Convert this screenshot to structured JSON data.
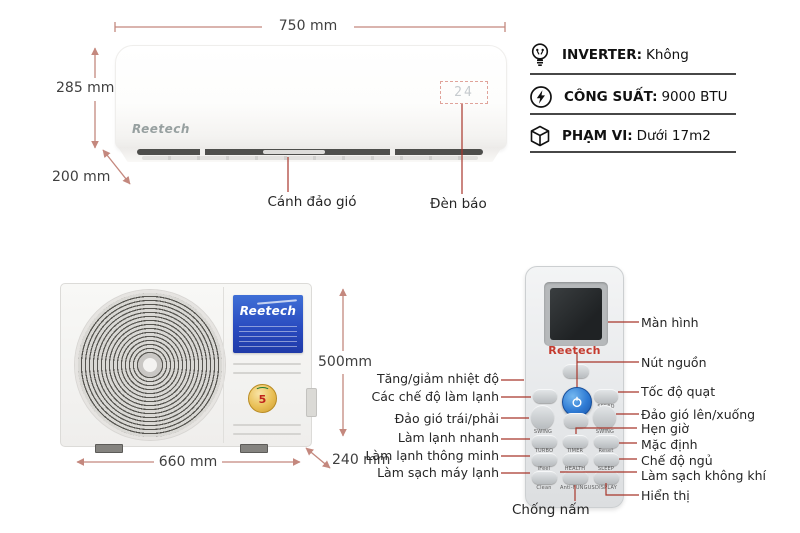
{
  "indoor": {
    "brand": "Reetech",
    "display_value": "24",
    "dim_width": "750 mm",
    "dim_height": "285 mm",
    "dim_depth": "200 mm",
    "label_swing": "Cánh đảo gió",
    "label_indicator": "Đèn báo"
  },
  "specs": [
    {
      "icon": "bulb-icon",
      "label": "INVERTER:",
      "value": "Không"
    },
    {
      "icon": "lightning-icon",
      "label": "CÔNG SUẤT:",
      "value": "9000 BTU"
    },
    {
      "icon": "cube-icon",
      "label": "PHẠM VI:",
      "value": "Dưới 17m2"
    }
  ],
  "outdoor": {
    "brand": "Reetech",
    "badge_number": "5",
    "dim_height": "500mm",
    "dim_width": "660 mm",
    "dim_depth": "240 mm"
  },
  "remote": {
    "brand": "Reetech",
    "tiny_labels": {
      "speed": "SPEED",
      "swing_left": "SWING",
      "swing_right": "SWING",
      "row1": [
        "TURBO",
        "TIMER",
        "Reset"
      ],
      "row2": [
        "iFeel",
        "HEALTH",
        "SLEEP"
      ],
      "row3": [
        "Clean",
        "Anti-FUNGUS",
        "DISPLAY"
      ]
    },
    "labels_left": [
      "Tăng/giảm nhiệt độ",
      "Các chế độ làm lạnh",
      "Đảo gió trái/phải",
      "Làm lạnh nhanh",
      "Làm lạnh thông minh",
      "Làm sạch máy lạnh"
    ],
    "labels_right": [
      "Màn hình",
      "Nút nguồn",
      "Tốc độ quạt",
      "Đảo gió lên/xuống",
      "Hẹn giờ",
      "Mặc định",
      "Chế độ ngủ",
      "Làm sạch không khí",
      "Hiển thị"
    ],
    "label_bottom": "Chống nấm"
  },
  "colors": {
    "dimension_line": "#c4887e",
    "pointer_line": "#a8362b",
    "brand_blue": "#2a4cc0",
    "brand_red": "#c43a2e"
  }
}
